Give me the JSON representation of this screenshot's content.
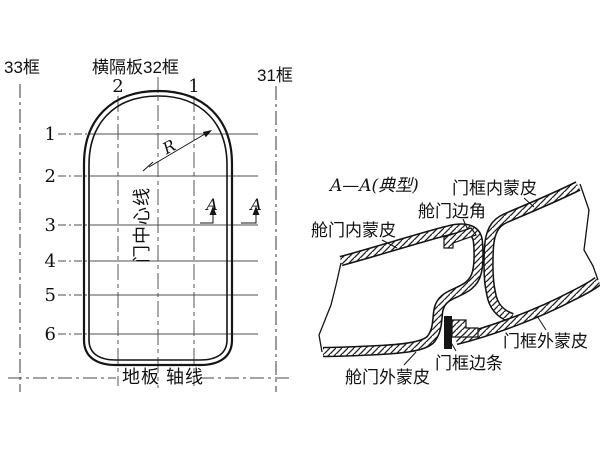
{
  "figure": {
    "background_color": "#ffffff",
    "ink_color": "#141414",
    "thin_line_color": "#4a4a4a"
  },
  "door_front_view": {
    "frame_left_label": "33框",
    "bulkhead_label": "横隔板32框",
    "frame_right_label": "31框",
    "vertical_station_labels": [
      "2",
      "1"
    ],
    "horizontal_station_labels": [
      "1",
      "2",
      "3",
      "4",
      "5",
      "6"
    ],
    "radius_label": "R",
    "section_arrow_label_left": "A",
    "section_arrow_label_right": "A",
    "door_centerline_label": "门中心线",
    "floor_axis_label": "地板 轴线"
  },
  "section_view": {
    "title": "A—A(典型)",
    "door_inner_skin_label": "舱门内蒙皮",
    "door_edge_angle_label": "舱门边角",
    "frame_inner_skin_label": "门框内蒙皮",
    "frame_outer_skin_label": "门框外蒙皮",
    "frame_edge_strip_label": "门框边条",
    "door_outer_skin_label": "舱门外蒙皮"
  }
}
